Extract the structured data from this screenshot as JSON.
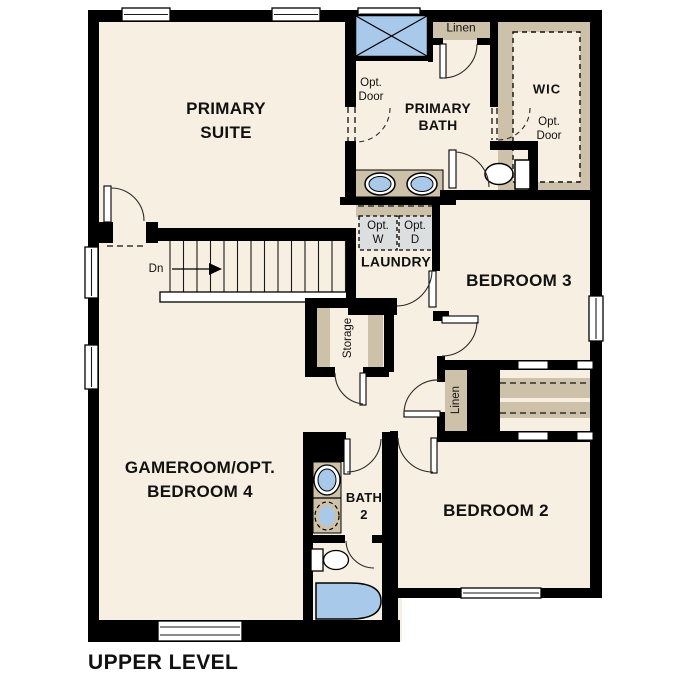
{
  "colors": {
    "floor": "#f7efe1",
    "wall": "#000000",
    "tan": "#cdc1a9",
    "blue": "#a9c9ea",
    "gray": "#dcdfdf"
  },
  "title": {
    "text": "UPPER LEVEL"
  },
  "rooms": {
    "primary_suite": {
      "line1": "PRIMARY",
      "line2": "SUITE"
    },
    "primary_bath": {
      "line1": "PRIMARY",
      "line2": "BATH"
    },
    "wic": {
      "label": "WIC"
    },
    "laundry": {
      "label": "LAUNDRY"
    },
    "bedroom_3": {
      "label": "BEDROOM 3"
    },
    "gameroom": {
      "line1": "GAMEROOM/OPT.",
      "line2": "BEDROOM 4"
    },
    "bath_2": {
      "line1": "BATH",
      "line2": "2"
    },
    "bedroom_2": {
      "label": "BEDROOM 2"
    },
    "storage": {
      "label": "Storage"
    }
  },
  "closets": {
    "linen_top": "Linen",
    "linen_mid": "Linen"
  },
  "annotations": {
    "stairs_down": "Dn",
    "opt_door_bath_line1": "Opt.",
    "opt_door_bath_line2": "Door",
    "opt_door_wic_line1": "Opt.",
    "opt_door_wic_line2": "Door",
    "opt_washer_line1": "Opt.",
    "opt_washer_line2": "W",
    "opt_dryer_line1": "Opt.",
    "opt_dryer_line2": "D"
  }
}
